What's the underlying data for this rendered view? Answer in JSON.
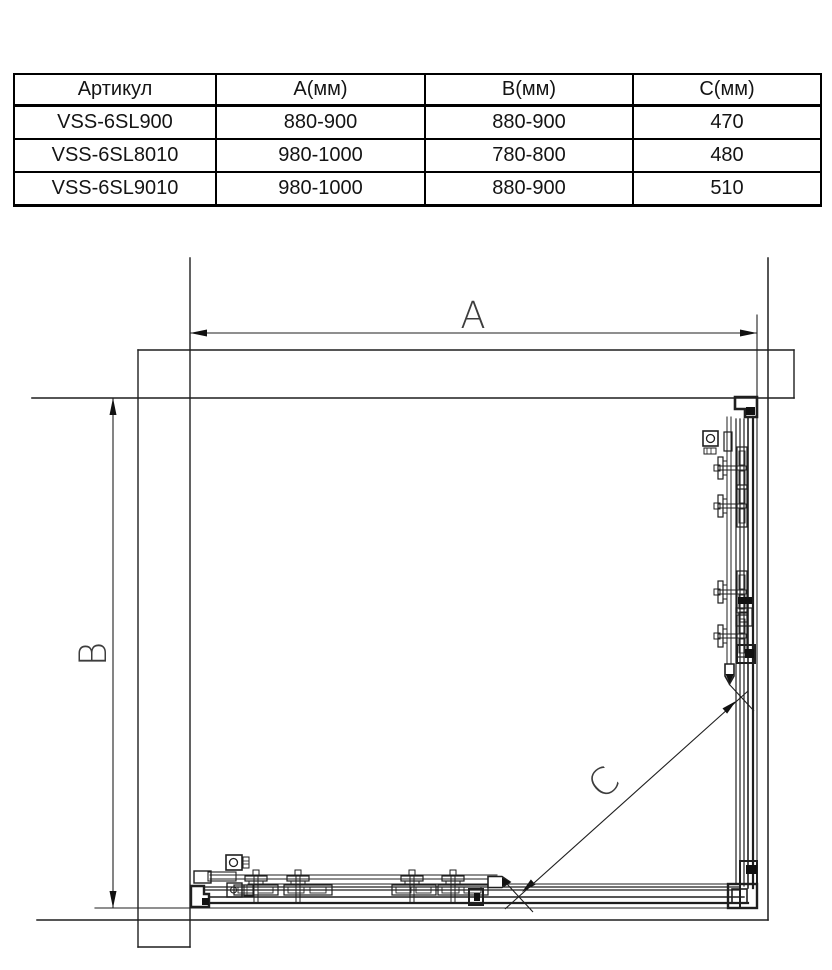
{
  "table": {
    "headers": [
      "Артикул",
      "А(мм)",
      "В(мм)",
      "С(мм)"
    ],
    "rows": [
      {
        "article": "VSS-6SL900",
        "a": "880-900",
        "b": "880-900",
        "c": "470"
      },
      {
        "article": "VSS-6SL8010",
        "a": "980-1000",
        "b": "780-800",
        "c": "480"
      },
      {
        "article": "VSS-6SL9010",
        "a": "980-1000",
        "b": "880-900",
        "c": "510"
      }
    ]
  },
  "diagram": {
    "dim_a_label": "A",
    "dim_b_label": "B",
    "dim_c_label": "C",
    "line_color": "#1f1f1f",
    "label_color": "#3d3d3d"
  }
}
